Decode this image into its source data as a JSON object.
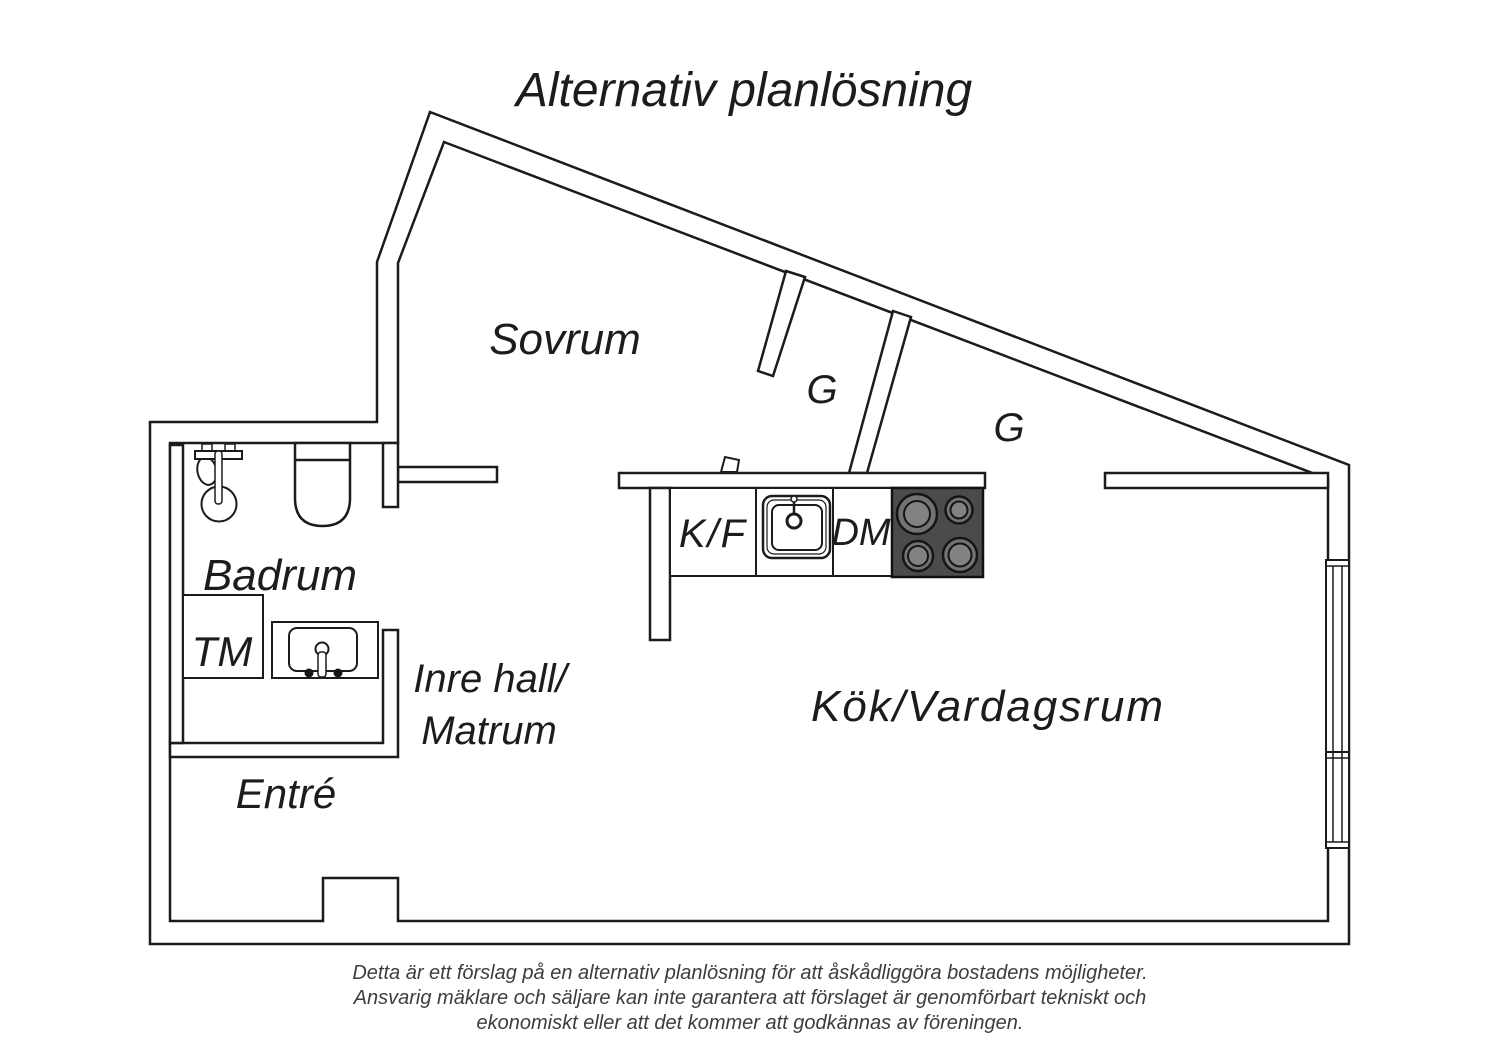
{
  "title": "Alternativ planlösning",
  "rooms": {
    "sovrum": "Sovrum",
    "closet1": "G",
    "closet2": "G",
    "badrum": "Badrum",
    "tm": "TM",
    "inre_hall_line1": "Inre hall/",
    "inre_hall_line2": "Matrum",
    "entre": "Entré",
    "kok_vardagsrum": "Kök/Vardagsrum"
  },
  "appliances": {
    "fridge_freezer": "K/F",
    "dishwasher": "DM"
  },
  "disclaimer": {
    "line1": "Detta är ett förslag på en alternativ planlösning för att åskådliggöra bostadens möjligheter.",
    "line2": "Ansvarig mäklare och säljare kan inte garantera att förslaget är genomförbart tekniskt och",
    "line3": "ekonomiskt eller att det kommer att godkännas av föreningen."
  },
  "colors": {
    "line": "#1b1b1b",
    "stove_body": "#4b4b4d",
    "burner_outer": "#737375",
    "burner_inner": "#828284",
    "background": "#ffffff"
  }
}
